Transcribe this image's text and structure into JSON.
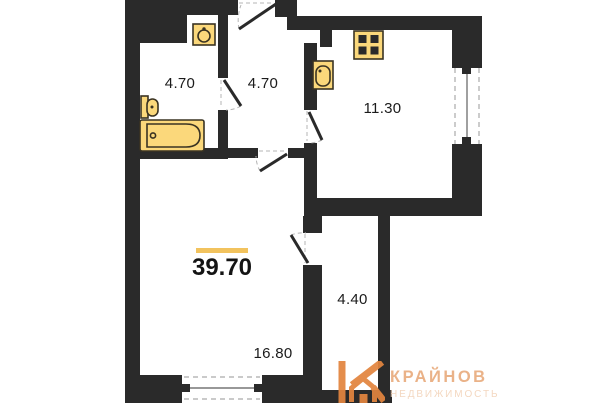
{
  "plan": {
    "total": {
      "area": "39.70"
    },
    "rooms": [
      {
        "id": "bathroom",
        "area": "4.70"
      },
      {
        "id": "hallway",
        "area": "4.70"
      },
      {
        "id": "kitchen",
        "area": "11.30"
      },
      {
        "id": "living-room",
        "area": "16.80"
      },
      {
        "id": "corridor",
        "area": "4.40"
      }
    ],
    "fixtures": [
      "bathroom-sink",
      "toilet",
      "bathtub",
      "stove",
      "kitchen-sink"
    ],
    "colors": {
      "wall": "#2a2a2a",
      "fixture_fill": "#fbd87b",
      "fixture_stroke": "#3a3322",
      "accent_line": "#f2c35e",
      "logo_orange": "#e2853f",
      "logo_text": "#e9ad7f",
      "logo_subtitle": "#f3d5bc"
    }
  },
  "logo": {
    "brand": "КРАЙНОВ",
    "subtitle": "НЕДВИЖИМОСТЬ"
  }
}
